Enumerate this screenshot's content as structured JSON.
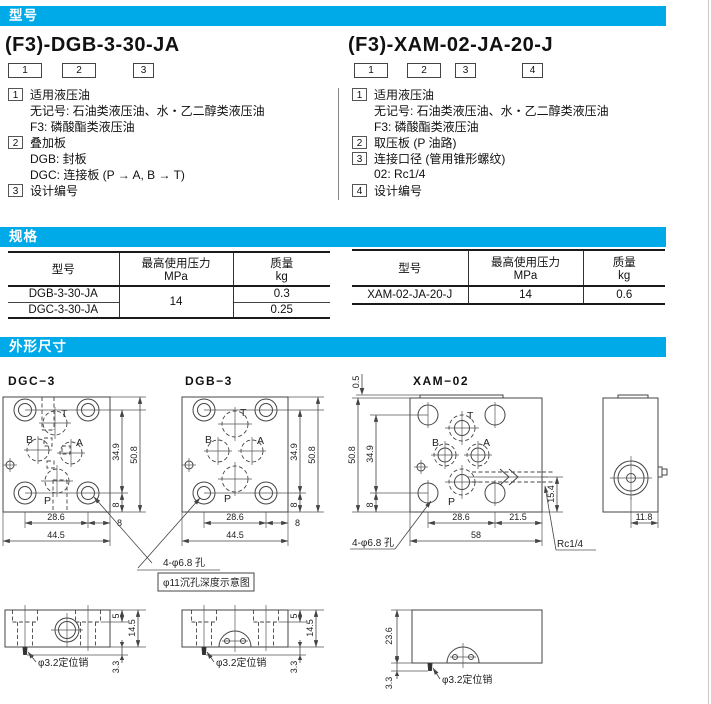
{
  "page": {
    "accent": "#00a9e8"
  },
  "sections": {
    "model": "型号",
    "spec": "规格",
    "outline": "外形尺寸"
  },
  "model_left": {
    "code": "(F3)-DGB-3-30-JA",
    "boxes": [
      "1",
      "2",
      "3"
    ],
    "items": [
      {
        "m": "1",
        "t": "适用液压油"
      },
      {
        "m": "",
        "t": "无记号: 石油类液压油、水・乙二醇类液压油"
      },
      {
        "m": "",
        "t": "F3: 磷酸酯类液压油"
      },
      {
        "m": "2",
        "t": "叠加板"
      },
      {
        "m": "",
        "t": "DGB: 封板"
      },
      {
        "m": "",
        "t": "DGC: 连接板 (P → A, B → T)"
      },
      {
        "m": "3",
        "t": "设计编号"
      }
    ]
  },
  "model_right": {
    "code": "(F3)-XAM-02-JA-20-J",
    "boxes": [
      "1",
      "2",
      "3",
      "4"
    ],
    "items": [
      {
        "m": "1",
        "t": "适用液压油"
      },
      {
        "m": "",
        "t": "无记号: 石油类液压油、水・乙二醇类液压油"
      },
      {
        "m": "",
        "t": "F3: 磷酸酯类液压油"
      },
      {
        "m": "2",
        "t": "取压板 (P 油路)"
      },
      {
        "m": "3",
        "t": "连接口径 (管用锥形螺纹)"
      },
      {
        "m": "",
        "t": "02: Rc1/4"
      },
      {
        "m": "4",
        "t": "设计编号"
      }
    ]
  },
  "spec": {
    "headers": {
      "model": "型号",
      "pressure": "最高使用压力",
      "pressure_unit": "MPa",
      "mass": "质量",
      "mass_unit": "kg"
    },
    "left": {
      "row1_model": "DGB-3-30-JA",
      "row2_model": "DGC-3-30-JA",
      "pressure": "14",
      "row1_mass": "0.3",
      "row2_mass": "0.25"
    },
    "right": {
      "row_model": "XAM-02-JA-20-J",
      "pressure": "14",
      "mass": "0.6"
    }
  },
  "drawings": {
    "titles": {
      "dgc": "DGC−3",
      "dgb": "DGB−3",
      "xam": "XAM−02"
    },
    "ports": {
      "t": "T",
      "b": "B",
      "a": "A",
      "p": "P"
    },
    "dims": {
      "d50_8": "50.8",
      "d34_9": "34.9",
      "d8": "8",
      "d28_6": "28.6",
      "d44_5": "44.5",
      "d0_5": "0.5",
      "d21_5": "21.5",
      "d58": "58",
      "d15_4": "15.4",
      "d11_8": "11.8",
      "d5": "5",
      "d14_5": "14.5",
      "d3_3": "3.3",
      "d23_6": "23.6"
    },
    "callouts": {
      "holes": "4-φ6.8 孔",
      "counterbore_note": "φ11沉孔深度示意图",
      "pin": "φ3.2定位销",
      "rc": "Rc1/4"
    }
  }
}
